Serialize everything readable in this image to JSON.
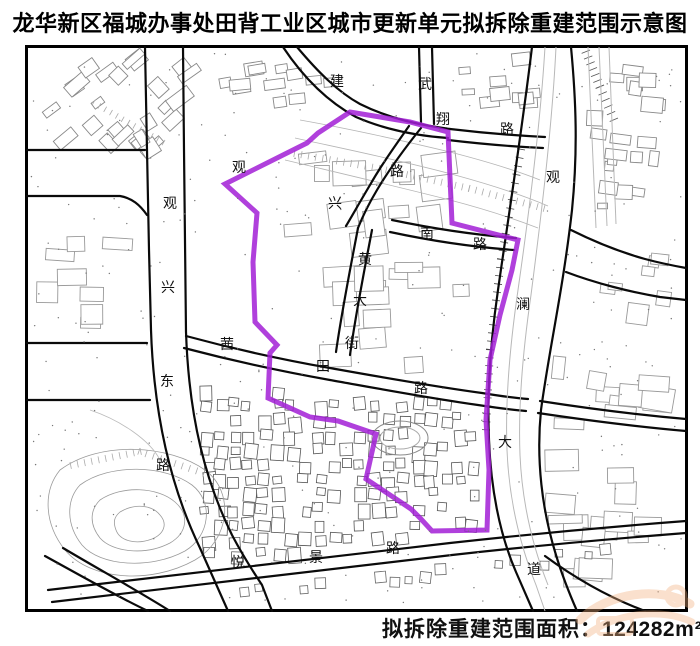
{
  "title": "龙华新区福城办事处田背工业区城市更新单元拟拆除重建范围示意图",
  "caption": {
    "label": "拟拆除重建范围面积：",
    "value": "124282",
    "unit": "m²"
  },
  "map": {
    "boundary": {
      "color": "#A21FD6",
      "points": [
        [
          225,
          184
        ],
        [
          293,
          150
        ],
        [
          307,
          143
        ],
        [
          318,
          133
        ],
        [
          350,
          112
        ],
        [
          410,
          122
        ],
        [
          448,
          132
        ],
        [
          452,
          223
        ],
        [
          518,
          240
        ],
        [
          512,
          270
        ],
        [
          500,
          315
        ],
        [
          490,
          360
        ],
        [
          486,
          420
        ],
        [
          489,
          470
        ],
        [
          487,
          530
        ],
        [
          432,
          531
        ],
        [
          421,
          519
        ],
        [
          411,
          509
        ],
        [
          366,
          479
        ],
        [
          376,
          434
        ],
        [
          338,
          421
        ],
        [
          310,
          417
        ],
        [
          268,
          398
        ],
        [
          270,
          353
        ],
        [
          277,
          345
        ],
        [
          255,
          322
        ],
        [
          253,
          262
        ],
        [
          257,
          213
        ]
      ]
    },
    "road_labels": [
      {
        "t": "建",
        "x": 330,
        "y": 86
      },
      {
        "t": "武",
        "x": 418,
        "y": 89
      },
      {
        "t": "翔",
        "x": 436,
        "y": 124
      },
      {
        "t": "路",
        "x": 500,
        "y": 134
      },
      {
        "t": "观",
        "x": 232,
        "y": 172
      },
      {
        "t": "兴",
        "x": 328,
        "y": 208
      },
      {
        "t": "路",
        "x": 390,
        "y": 176
      },
      {
        "t": "观",
        "x": 163,
        "y": 208
      },
      {
        "t": "兴",
        "x": 161,
        "y": 292
      },
      {
        "t": "东",
        "x": 160,
        "y": 386
      },
      {
        "t": "路",
        "x": 156,
        "y": 470
      },
      {
        "t": "南",
        "x": 420,
        "y": 238
      },
      {
        "t": "路",
        "x": 473,
        "y": 249
      },
      {
        "t": "黄",
        "x": 358,
        "y": 264
      },
      {
        "t": "大",
        "x": 353,
        "y": 305
      },
      {
        "t": "街",
        "x": 345,
        "y": 348
      },
      {
        "t": "茜",
        "x": 220,
        "y": 349
      },
      {
        "t": "田",
        "x": 316,
        "y": 371
      },
      {
        "t": "路",
        "x": 414,
        "y": 393
      },
      {
        "t": "观",
        "x": 546,
        "y": 182
      },
      {
        "t": "澜",
        "x": 516,
        "y": 309
      },
      {
        "t": "大",
        "x": 498,
        "y": 447
      },
      {
        "t": "道",
        "x": 527,
        "y": 574
      },
      {
        "t": "悦",
        "x": 231,
        "y": 567
      },
      {
        "t": "景",
        "x": 309,
        "y": 562
      },
      {
        "t": "路",
        "x": 386,
        "y": 553
      }
    ],
    "watermark_color": "#f2b07e"
  }
}
